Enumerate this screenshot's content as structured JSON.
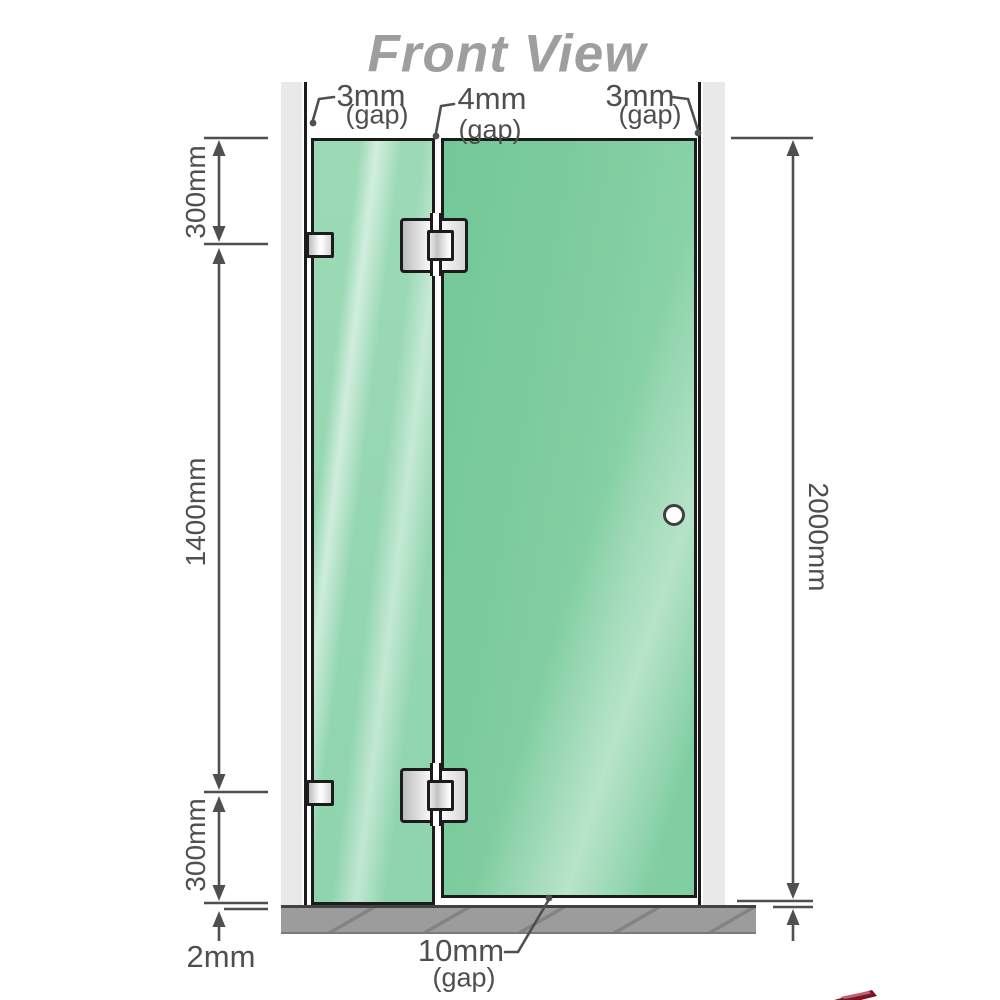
{
  "title": "Front View",
  "top_annotations": [
    {
      "value": "3mm",
      "note": "(gap)"
    },
    {
      "value": "4mm",
      "note": "(gap)"
    },
    {
      "value": "3mm",
      "note": "(gap)"
    }
  ],
  "left_dimensions": [
    "300mm",
    "1400mm",
    "300mm"
  ],
  "right_dimension": "2000mm",
  "bottom_dimensions": {
    "floor_thickness": "2mm",
    "bottom_gap_value": "10mm",
    "bottom_gap_note": "(gap)"
  },
  "colors": {
    "glass_green": "#84cfa4",
    "glass_green_light": "#c3ebd4",
    "wall_gray": "#e9e9e9",
    "floor_gray": "#9c9c9c",
    "line_color": "#4f4f4f",
    "outline_black": "#1c1c1c",
    "title_gray": "#9e9e9e",
    "accent_red": "#7c1322"
  }
}
